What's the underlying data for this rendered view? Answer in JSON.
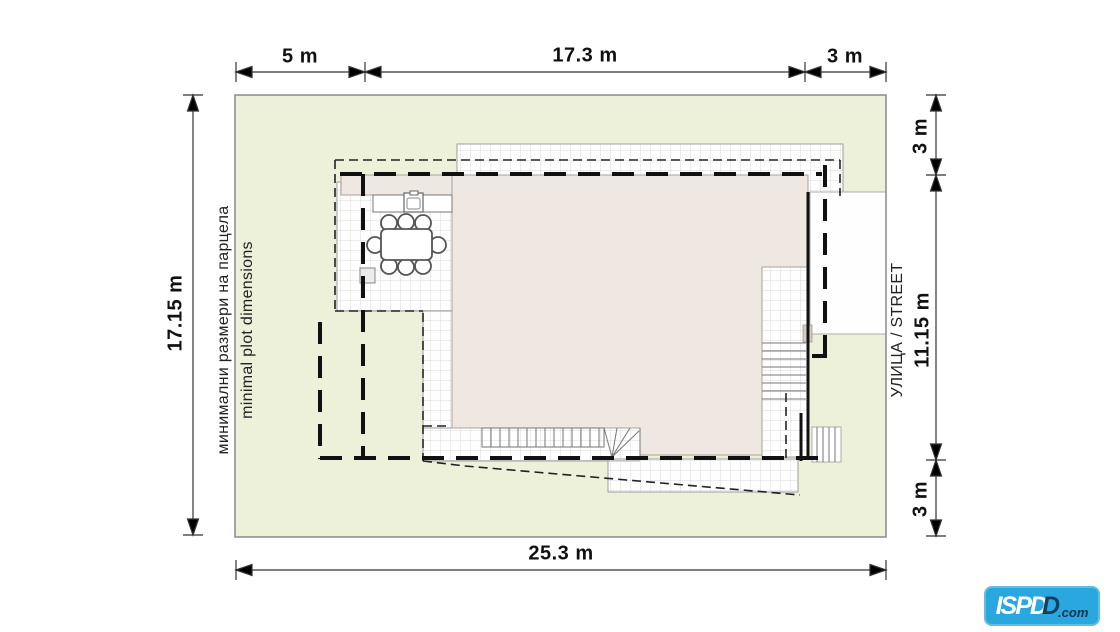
{
  "dimensions": {
    "top": [
      {
        "label": "5 m"
      },
      {
        "label": "17.3 m"
      },
      {
        "label": "3 m"
      }
    ],
    "bottom": {
      "label": "25.3 m"
    },
    "left": {
      "label": "17.15 m"
    },
    "right": [
      {
        "label": "3 m"
      },
      {
        "label": "11.15 m"
      },
      {
        "label": "3 m"
      }
    ]
  },
  "captions": {
    "plot_line1": "минимални размери на парцела",
    "plot_line2": "minimal plot dimensions",
    "street": "УЛИЦА / STREET"
  },
  "logo": {
    "white_text": "ISPD",
    "dark_text": "D",
    "suffix": ".com"
  },
  "colors": {
    "page_bg": "#ffffff",
    "plot_fill": "#edf1da",
    "roof_fill": "#efe8e2",
    "paving_fill": "#fefefe",
    "logo_bg": "#2aa7de",
    "line_color": "#333333"
  }
}
